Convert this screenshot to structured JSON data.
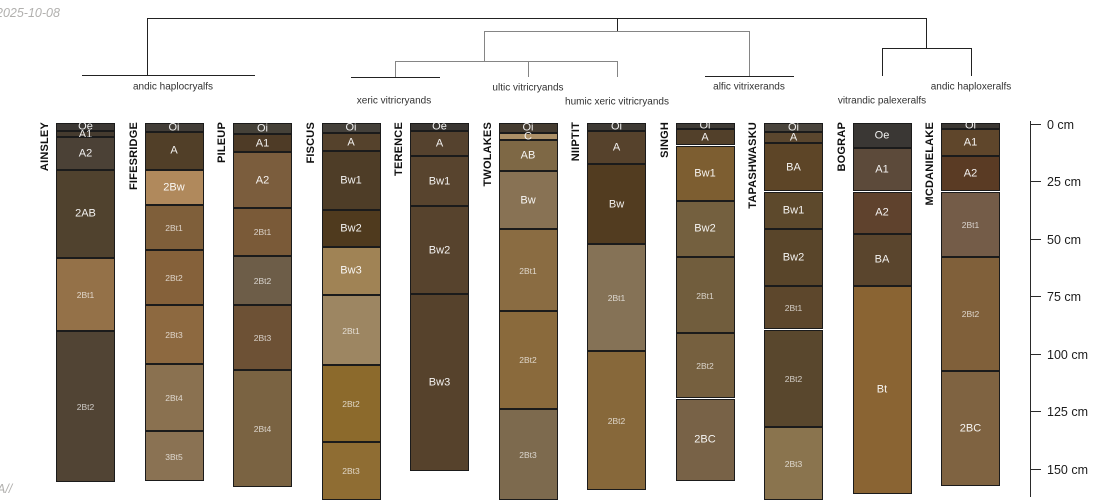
{
  "annotations": {
    "date": "2025-10-08",
    "corner": "A//"
  },
  "chart_data": {
    "type": "bar",
    "variant": "soil-profile-sketches-with-cluster-dendrogram",
    "title": "",
    "ylabel": "depth (cm)",
    "ylim": [
      0,
      165
    ],
    "depth_unit": "cm",
    "depth_ticks": [
      {
        "value": 0,
        "label": "0 cm"
      },
      {
        "value": 25,
        "label": "25 cm"
      },
      {
        "value": 50,
        "label": "50 cm"
      },
      {
        "value": 75,
        "label": "75 cm"
      },
      {
        "value": 100,
        "label": "100 cm"
      },
      {
        "value": 125,
        "label": "125 cm"
      },
      {
        "value": 150,
        "label": "150 cm"
      }
    ],
    "clusters": [
      {
        "label": "andic haplocryalfs",
        "x": 173,
        "y": 87
      },
      {
        "label": "xeric vitricryands",
        "x": 394,
        "y": 101
      },
      {
        "label": "ultic vitricryands",
        "x": 528,
        "y": 88
      },
      {
        "label": "humic xeric vitricryands",
        "x": 617,
        "y": 102
      },
      {
        "label": "alfic vitrixerands",
        "x": 749,
        "y": 87
      },
      {
        "label": "vitrandic palexeralfs",
        "x": 882,
        "y": 101
      },
      {
        "label": "andic haploxeralfs",
        "x": 971,
        "y": 87
      }
    ],
    "categories": [
      "AINSLEY",
      "FIFESRIDGE",
      "PILEUP",
      "FISCUS",
      "TERENCE",
      "TWOLAKES",
      "NIIPTIT",
      "SINGH",
      "TAPASHWASKU",
      "BOGRAP",
      "MCDANIELAKE"
    ],
    "profiles": [
      {
        "name": "AINSLEY",
        "horizons": [
          {
            "name": "Oe",
            "top": 0,
            "bottom": 3.5,
            "color": "#3c3834"
          },
          {
            "name": "A1",
            "top": 3.5,
            "bottom": 6.5,
            "color": "#453b2f"
          },
          {
            "name": "A2",
            "top": 6.5,
            "bottom": 20.5,
            "color": "#4b4136"
          },
          {
            "name": "2AB",
            "top": 20.5,
            "bottom": 59,
            "color": "#50422e"
          },
          {
            "name": "2Bt1",
            "top": 59,
            "bottom": 90.5,
            "color": "#947148"
          },
          {
            "name": "2Bt2",
            "top": 90.5,
            "bottom": 156.5,
            "color": "#514434"
          }
        ]
      },
      {
        "name": "FIFESRIDGE",
        "horizons": [
          {
            "name": "Oi",
            "top": 0,
            "bottom": 4,
            "color": "#423d37"
          },
          {
            "name": "A",
            "top": 4,
            "bottom": 20.5,
            "color": "#513f28"
          },
          {
            "name": "2Bw",
            "top": 20.5,
            "bottom": 36,
            "color": "#b0895c"
          },
          {
            "name": "2Bt1",
            "top": 36,
            "bottom": 55.5,
            "color": "#7f5f3a"
          },
          {
            "name": "2Bt2",
            "top": 55.5,
            "bottom": 79.5,
            "color": "#85613a"
          },
          {
            "name": "2Bt3",
            "top": 79.5,
            "bottom": 105,
            "color": "#8d6940"
          },
          {
            "name": "2Bt4",
            "top": 105,
            "bottom": 134,
            "color": "#8a7150"
          },
          {
            "name": "3Bt5",
            "top": 134,
            "bottom": 156,
            "color": "#8a7253"
          }
        ]
      },
      {
        "name": "PILEUP",
        "horizons": [
          {
            "name": "Oi",
            "top": 0,
            "bottom": 5,
            "color": "#454138"
          },
          {
            "name": "A1",
            "top": 5,
            "bottom": 13,
            "color": "#4e3b26"
          },
          {
            "name": "A2",
            "top": 13,
            "bottom": 37,
            "color": "#7b5d3d"
          },
          {
            "name": "2Bt1",
            "top": 37,
            "bottom": 58,
            "color": "#7a5a38"
          },
          {
            "name": "2Bt2",
            "top": 58,
            "bottom": 79.5,
            "color": "#6d5d48"
          },
          {
            "name": "2Bt3",
            "top": 79.5,
            "bottom": 107.5,
            "color": "#6d5135"
          },
          {
            "name": "2Bt4",
            "top": 107.5,
            "bottom": 158.5,
            "color": "#7a6342"
          }
        ]
      },
      {
        "name": "FISCUS",
        "horizons": [
          {
            "name": "Oi",
            "top": 0,
            "bottom": 4.5,
            "color": "#44403a"
          },
          {
            "name": "A",
            "top": 4.5,
            "bottom": 12.5,
            "color": "#55422c"
          },
          {
            "name": "Bw1",
            "top": 12.5,
            "bottom": 38,
            "color": "#4e3d27"
          },
          {
            "name": "Bw2",
            "top": 38,
            "bottom": 54,
            "color": "#4f3a1e"
          },
          {
            "name": "Bw3",
            "top": 54,
            "bottom": 75,
            "color": "#a08355"
          },
          {
            "name": "2Bt1",
            "top": 75,
            "bottom": 105.5,
            "color": "#9d8662"
          },
          {
            "name": "2Bt2",
            "top": 105.5,
            "bottom": 139,
            "color": "#8c6a2c"
          },
          {
            "name": "2Bt3",
            "top": 139,
            "bottom": 164,
            "color": "#8f6d33"
          }
        ]
      },
      {
        "name": "TERENCE",
        "horizons": [
          {
            "name": "Oe",
            "top": 0,
            "bottom": 3.5,
            "color": "#3a3632"
          },
          {
            "name": "A",
            "top": 3.5,
            "bottom": 14.5,
            "color": "#55422e"
          },
          {
            "name": "Bw1",
            "top": 14.5,
            "bottom": 36.5,
            "color": "#58442e"
          },
          {
            "name": "Bw2",
            "top": 36.5,
            "bottom": 74.5,
            "color": "#57432d"
          },
          {
            "name": "Bw3",
            "top": 74.5,
            "bottom": 151.5,
            "color": "#56422c"
          }
        ]
      },
      {
        "name": "TWOLAKES",
        "horizons": [
          {
            "name": "Oi",
            "top": 0,
            "bottom": 4.5,
            "color": "#453c31"
          },
          {
            "name": "C",
            "top": 4.5,
            "bottom": 7.5,
            "color": "#ac9067"
          },
          {
            "name": "AB",
            "top": 7.5,
            "bottom": 21,
            "color": "#7e6845"
          },
          {
            "name": "Bw",
            "top": 21,
            "bottom": 46.5,
            "color": "#887254"
          },
          {
            "name": "2Bt1",
            "top": 46.5,
            "bottom": 82,
            "color": "#8a6c42"
          },
          {
            "name": "2Bt2",
            "top": 82,
            "bottom": 124.5,
            "color": "#8a6a3c"
          },
          {
            "name": "2Bt3",
            "top": 124.5,
            "bottom": 164,
            "color": "#7d6a4e"
          }
        ]
      },
      {
        "name": "NIIPTIT",
        "horizons": [
          {
            "name": "Oi",
            "top": 0,
            "bottom": 3.5,
            "color": "#3e3a34"
          },
          {
            "name": "A",
            "top": 3.5,
            "bottom": 18,
            "color": "#56422c"
          },
          {
            "name": "Bw",
            "top": 18,
            "bottom": 53,
            "color": "#523c20"
          },
          {
            "name": "2Bt1",
            "top": 53,
            "bottom": 99.5,
            "color": "#857256"
          },
          {
            "name": "2Bt2",
            "top": 99.5,
            "bottom": 160,
            "color": "#87683a"
          }
        ]
      },
      {
        "name": "SINGH",
        "horizons": [
          {
            "name": "Oi",
            "top": 0,
            "bottom": 3,
            "color": "#3f3b35"
          },
          {
            "name": "A",
            "top": 3,
            "bottom": 10,
            "color": "#52402a"
          },
          {
            "name": "Bw1",
            "top": 10,
            "bottom": 34,
            "color": "#7d5e31"
          },
          {
            "name": "Bw2",
            "top": 34,
            "bottom": 58.5,
            "color": "#74603f"
          },
          {
            "name": "2Bt1",
            "top": 58.5,
            "bottom": 91.5,
            "color": "#715d3d"
          },
          {
            "name": "2Bt2",
            "top": 91.5,
            "bottom": 120,
            "color": "#76603f"
          },
          {
            "name": "2BC",
            "top": 120,
            "bottom": 156,
            "color": "#786247"
          }
        ]
      },
      {
        "name": "TAPASHWASKU",
        "horizons": [
          {
            "name": "Oi",
            "top": 0,
            "bottom": 4,
            "color": "#49443c"
          },
          {
            "name": "A",
            "top": 4,
            "bottom": 9,
            "color": "#5a462e"
          },
          {
            "name": "BA",
            "top": 9,
            "bottom": 30,
            "color": "#5d4527"
          },
          {
            "name": "Bw1",
            "top": 30,
            "bottom": 46.5,
            "color": "#5d492c"
          },
          {
            "name": "Bw2",
            "top": 46.5,
            "bottom": 71,
            "color": "#59452a"
          },
          {
            "name": "2Bt1",
            "top": 71,
            "bottom": 90,
            "color": "#5d472c"
          },
          {
            "name": "2Bt2",
            "top": 90,
            "bottom": 132.5,
            "color": "#59472d"
          },
          {
            "name": "2Bt3",
            "top": 132.5,
            "bottom": 164,
            "color": "#8a744e"
          }
        ]
      },
      {
        "name": "BOGRAP",
        "horizons": [
          {
            "name": "Oe",
            "top": 0,
            "bottom": 11,
            "color": "#3a3734"
          },
          {
            "name": "A1",
            "top": 11,
            "bottom": 30,
            "color": "#5c4a3a"
          },
          {
            "name": "A2",
            "top": 30,
            "bottom": 48.5,
            "color": "#5f422d"
          },
          {
            "name": "BA",
            "top": 48.5,
            "bottom": 71,
            "color": "#5a452d"
          },
          {
            "name": "Bt",
            "top": 71,
            "bottom": 161.5,
            "color": "#8a6433"
          }
        ]
      },
      {
        "name": "MCDANIELAKE",
        "horizons": [
          {
            "name": "Oi",
            "top": 0,
            "bottom": 3,
            "color": "#3b3732"
          },
          {
            "name": "A1",
            "top": 3,
            "bottom": 14.5,
            "color": "#5f462b"
          },
          {
            "name": "A2",
            "top": 14.5,
            "bottom": 30,
            "color": "#5a3b24"
          },
          {
            "name": "2Bt1",
            "top": 30,
            "bottom": 58.5,
            "color": "#745c48"
          },
          {
            "name": "2Bt2",
            "top": 58.5,
            "bottom": 108,
            "color": "#80603a"
          },
          {
            "name": "2BC",
            "top": 108,
            "bottom": 158,
            "color": "#7f6341"
          }
        ]
      }
    ]
  }
}
